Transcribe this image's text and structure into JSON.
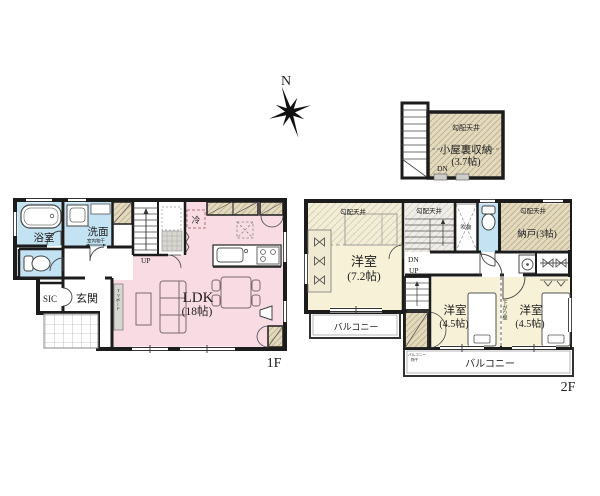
{
  "compass": {
    "north": "N"
  },
  "attic": {
    "ceiling": "勾配天井",
    "name": "小屋裏収納",
    "size": "(3.7帖)",
    "dn": "DN"
  },
  "f1": {
    "floor": "1F",
    "bath": "浴室",
    "wash": "洗面",
    "indoor_dry": "室内物干",
    "sic": "SIC",
    "entry": "玄関",
    "up": "UP",
    "fridge": "冷",
    "ldk": "LDK",
    "ldk_size": "(18帖)",
    "tv": "TVボード"
  },
  "f2": {
    "floor": "2F",
    "ceiling": "勾配天井",
    "room1": "洋室",
    "room1_size": "(7.2帖)",
    "dn": "DN",
    "up": "UP",
    "void": "吹抜",
    "storage": "納戸(3帖)",
    "room2": "洋室",
    "room2_size": "(4.5帖)",
    "room3": "洋室",
    "room3_size": "(4.5帖)",
    "lowered_wall": "下がり壁",
    "balcony_side": "バルコニー",
    "balcony_south": "バルコニー",
    "balcony_dry1": "バルコニー",
    "balcony_dry2": "物干"
  },
  "colors": {
    "water_blue": "#c3e2f2",
    "ldk_pink": "#f8dbe3",
    "room_cream": "#f6f1d7",
    "closet_beige": "#e3d9bd",
    "wall": "#1c1c1c"
  }
}
